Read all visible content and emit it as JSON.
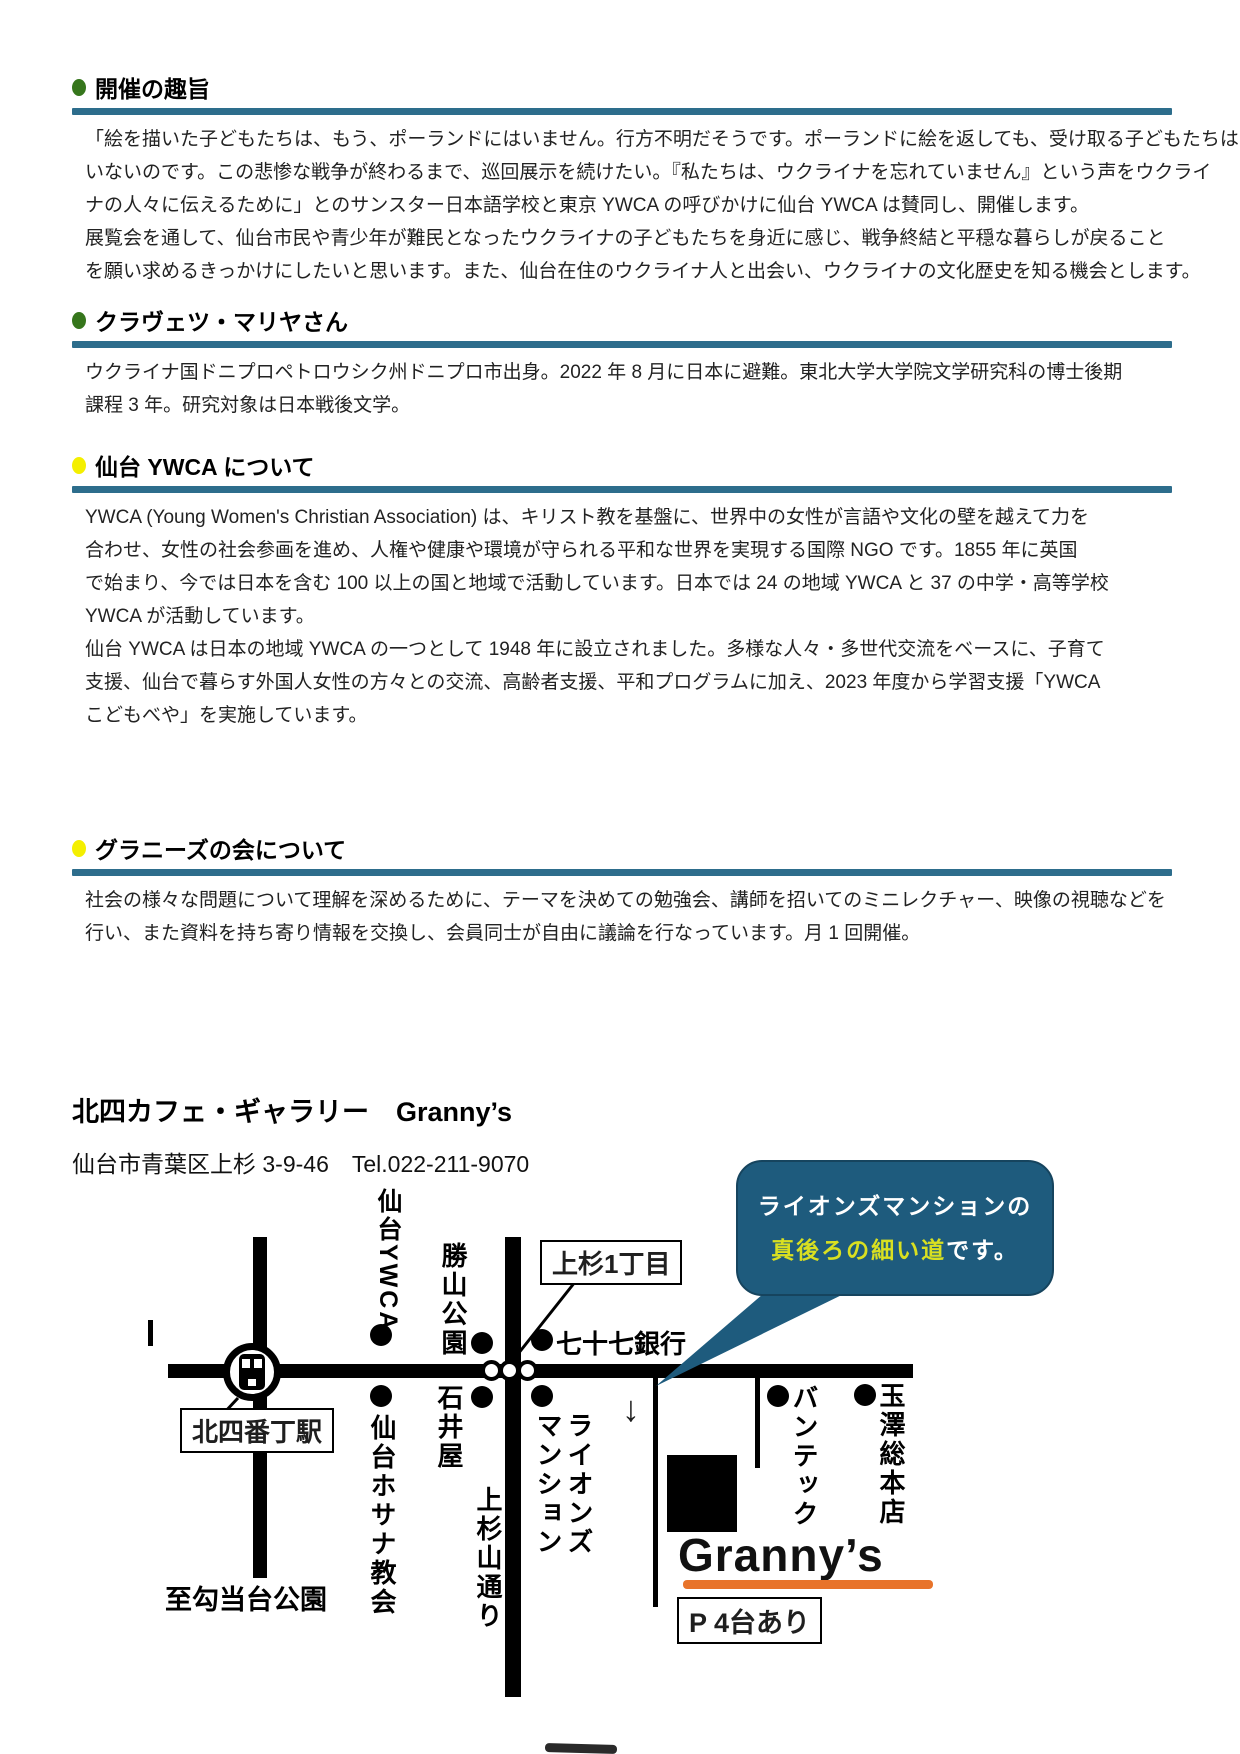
{
  "colors": {
    "accent_rule": "#2d6d8c",
    "bullet_green": "#36761c",
    "bullet_yellow": "#f4ef00",
    "bubble_bg": "#1e5b7d",
    "bubble_highlight": "#d9e021",
    "underline_orange": "#e8732a"
  },
  "sections": [
    {
      "title": "開催の趣旨",
      "bullet_color": "#36761c",
      "lines": [
        "「絵を描いた子どもたちは、もう、ポーランドにはいません。行方不明だそうです。ポーランドに絵を返しても、受け取る子どもたちは",
        "いないのです。この悲惨な戦争が終わるまで、巡回展示を続けたい。『私たちは、ウクライナを忘れていません』という声をウクライ",
        "ナの人々に伝えるために」とのサンスター日本語学校と東京 YWCA の呼びかけに仙台 YWCA は賛同し、開催します。",
        "展覧会を通して、仙台市民や青少年が難民となったウクライナの子どもたちを身近に感じ、戦争終結と平穏な暮らしが戻ること",
        "を願い求めるきっかけにしたいと思います。また、仙台在住のウクライナ人と出会い、ウクライナの文化歴史を知る機会とします。"
      ]
    },
    {
      "title": "クラヴェツ・マリヤさん",
      "bullet_color": "#36761c",
      "lines": [
        "ウクライナ国ドニプロペトロウシク州ドニプロ市出身。2022 年 8 月に日本に避難。東北大学大学院文学研究科の博士後期",
        "課程 3 年。研究対象は日本戦後文学。"
      ]
    },
    {
      "title": "仙台 YWCA について",
      "bullet_color": "#f4ef00",
      "lines": [
        "YWCA (Young Women's Christian Association) は、キリスト教を基盤に、世界中の女性が言語や文化の壁を越えて力を",
        "合わせ、女性の社会参画を進め、人権や健康や環境が守られる平和な世界を実現する国際 NGO です。1855 年に英国",
        "で始まり、今では日本を含む 100 以上の国と地域で活動しています。日本では 24 の地域 YWCA と 37 の中学・高等学校",
        "YWCA が活動しています。",
        "仙台 YWCA は日本の地域 YWCA の一つとして 1948 年に設立されました。多様な人々・多世代交流をベースに、子育て",
        "支援、仙台で暮らす外国人女性の方々との交流、高齢者支援、平和プログラムに加え、2023 年度から学習支援「YWCA",
        "こどもべや」を実施しています。"
      ]
    },
    {
      "title": "グラニーズの会について",
      "bullet_color": "#f4ef00",
      "lines": [
        "社会の様々な問題について理解を深めるために、テーマを決めての勉強会、講師を招いてのミニレクチャー、映像の視聴などを",
        "行い、また資料を持ち寄り情報を交換し、会員同士が自由に議論を行なっています。月 1 回開催。"
      ]
    }
  ],
  "venue": {
    "name": "北四カフェ・ギャラリー　Granny’s",
    "address": "仙台市青葉区上杉 3-9-46　Tel.022-211-9070"
  },
  "map": {
    "sendai_ywca": "仙台YWCA",
    "katsuyama_park": "勝山公園",
    "kamisugi_1chome": "上杉1丁目",
    "shichijushichi_bank": "七十七銀行",
    "kitayobancho_station": "北四番丁駅",
    "ishiiya": "石井屋",
    "hosanna_church": "仙台ホサナ教会",
    "kamisugiyama_dori": "上杉山通り",
    "lions_mansion": "ライオンズマンション",
    "vantec": "バンテック",
    "tamazawa": "玉澤総本店",
    "to_kotodai_park": "至勾当台公園",
    "grannys": "Granny’s",
    "parking": "P 4台あり",
    "arrow_down": "↓"
  },
  "bubble": {
    "line1": "ライオンズマンションの",
    "highlight": "真後ろの細い道",
    "suffix": "です。"
  }
}
